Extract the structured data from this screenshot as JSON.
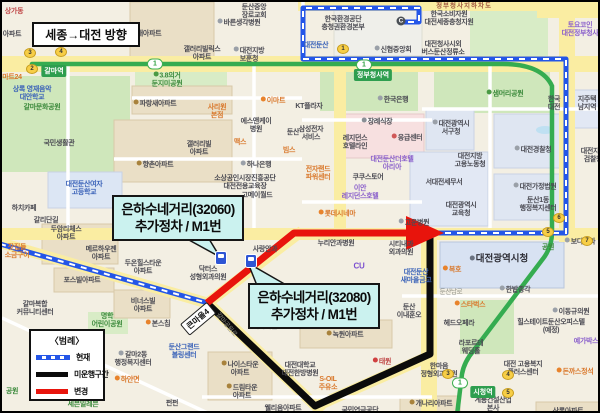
{
  "frame": {
    "direction_title": "세종→대전 방향"
  },
  "callouts": [
    {
      "line1": "은하수네거리(32060)",
      "line2": "추가정차 / M1번"
    },
    {
      "line1": "은하수네거리(32080)",
      "line2": "추가정차 / M1번"
    }
  ],
  "legend": {
    "title": "〈범례〉",
    "items": [
      {
        "label": "현재",
        "swatch": "sw-current"
      },
      {
        "label": "미운행구간",
        "swatch": "sw-removed"
      },
      {
        "label": "변경",
        "swatch": "sw-changed"
      }
    ]
  },
  "colors": {
    "route_current": "#2456E8",
    "route_removed": "#0B0B0B",
    "route_changed": "#E8140C",
    "subway_line": "#35AC50",
    "callout_bg": "#CBF2EF"
  },
  "map": {
    "road_badge": {
      "t": "큰마을4",
      "x": 196,
      "y": 317
    },
    "c_icon": {
      "x": 399,
      "y": 19
    },
    "subway_pills": [
      {
        "n": "1",
        "x": 153,
        "y": 62
      },
      {
        "n": "1",
        "x": 362,
        "y": 63
      },
      {
        "n": "1",
        "x": 458,
        "y": 381
      }
    ],
    "station_badges": [
      {
        "t": "갈마역",
        "x": 52,
        "y": 69
      },
      {
        "t": "정부청사역",
        "x": 371,
        "y": 73
      },
      {
        "t": "시청역",
        "x": 481,
        "y": 390
      }
    ],
    "exit_ovals": [
      {
        "n": "3",
        "x": 28,
        "y": 51
      },
      {
        "n": "4",
        "x": 59,
        "y": 50
      },
      {
        "n": "2",
        "x": 30,
        "y": 67
      },
      {
        "n": "1",
        "x": 341,
        "y": 47
      },
      {
        "n": "6",
        "x": 557,
        "y": 216
      },
      {
        "n": "5",
        "x": 546,
        "y": 230
      },
      {
        "n": "7",
        "x": 585,
        "y": 239
      },
      {
        "n": "3",
        "x": 446,
        "y": 372
      },
      {
        "n": "4",
        "x": 506,
        "y": 373
      },
      {
        "n": "5",
        "x": 506,
        "y": 391
      }
    ],
    "bus_stops": [
      {
        "x": 219,
        "y": 256
      },
      {
        "x": 249,
        "y": 259
      }
    ],
    "labels": [
      {
        "t": "둔산중앙\n장로교회",
        "x": 252,
        "y": 10
      },
      {
        "t": "바른생각병원",
        "x": 237,
        "y": 21,
        "ic": "#9aa0a8"
      },
      {
        "t": "상가동",
        "x": 12,
        "y": 10,
        "c": "c-red"
      },
      {
        "t": "아파트",
        "x": 10,
        "y": 33
      },
      {
        "t": "지개아파트",
        "x": 141,
        "y": 32,
        "ic": "#a8823c"
      },
      {
        "t": "갤러리빌릭스\n아파트",
        "x": 200,
        "y": 52
      },
      {
        "t": "대전지방\n보훈청",
        "x": 247,
        "y": 53,
        "ic": "#9aa0a8"
      },
      {
        "t": "한국환경공단\n충청권환경본부",
        "x": 341,
        "y": 22
      },
      {
        "t": "한국소비자원\n대전세종충청지원",
        "x": 447,
        "y": 17
      },
      {
        "t": "대전청사시외\n버스둔산정류소",
        "x": 441,
        "y": 47
      },
      {
        "t": "신협중앙회",
        "x": 391,
        "y": 48,
        "ic": "#9aa0a8"
      },
      {
        "t": "대전둔산",
        "x": 314,
        "y": 44,
        "c": "c-blue"
      },
      {
        "t": "토요코인\n대전정부청사",
        "x": 578,
        "y": 28,
        "c": "c-purple"
      },
      {
        "t": "마트24",
        "x": 10,
        "y": 76,
        "c": "c-orange"
      },
      {
        "t": "상록 영재음악\n대안학교",
        "x": 30,
        "y": 92,
        "c": "c-blue"
      },
      {
        "t": "갈마문화공원",
        "x": 40,
        "y": 106,
        "c": "c-green"
      },
      {
        "t": "3.8의거\n둔지미공원",
        "x": 165,
        "y": 78,
        "c": "c-green",
        "ic": "#4a9a44"
      },
      {
        "t": "파랑새아파트",
        "x": 153,
        "y": 102,
        "ic": "#a8823c"
      },
      {
        "t": "사리원\n본점",
        "x": 215,
        "y": 110,
        "c": "c-orange"
      },
      {
        "t": "이마트",
        "x": 271,
        "y": 99,
        "c": "c-orange",
        "ic": "#e8832c"
      },
      {
        "t": "KT플라자",
        "x": 307,
        "y": 105
      },
      {
        "t": "한국은행",
        "x": 391,
        "y": 98,
        "ic": "#9aa0a8"
      },
      {
        "t": "샘머리공원",
        "x": 503,
        "y": 92,
        "c": "c-green",
        "ic": "#4a9a44"
      },
      {
        "t": "한국\n대전",
        "x": 552,
        "y": 102
      },
      {
        "t": "지주택\n남지역",
        "x": 585,
        "y": 102
      },
      {
        "t": "에스앤케이\n병원",
        "x": 254,
        "y": 124
      },
      {
        "t": "둔산",
        "x": 291,
        "y": 131
      },
      {
        "t": "맥스",
        "x": 238,
        "y": 141,
        "c": "c-orange"
      },
      {
        "t": "빔스",
        "x": 287,
        "y": 149,
        "c": "c-orange"
      },
      {
        "t": "갤러리빌\n아파트",
        "x": 197,
        "y": 147
      },
      {
        "t": "향촌아파트",
        "x": 153,
        "y": 163,
        "ic": "#a8823c"
      },
      {
        "t": "하나은행",
        "x": 254,
        "y": 163,
        "ic": "#9aa0a8"
      },
      {
        "t": "국민생활관",
        "x": 57,
        "y": 142
      },
      {
        "t": "대전둔산여자\n고등학교",
        "x": 82,
        "y": 187,
        "c": "c-blue"
      },
      {
        "t": "소상공인시장진흥공단\n대전전용교육장",
        "x": 243,
        "y": 181
      },
      {
        "t": "고메이월드",
        "x": 255,
        "y": 194
      },
      {
        "t": "하치카페",
        "x": 22,
        "y": 207
      },
      {
        "t": "갈리단길",
        "x": 44,
        "y": 219
      },
      {
        "t": "삼성전자\n서비스",
        "x": 309,
        "y": 132
      },
      {
        "t": "장례식장",
        "x": 375,
        "y": 120,
        "ic": "#8a8f96"
      },
      {
        "t": "레지던스\n호텔라인",
        "x": 353,
        "y": 141
      },
      {
        "t": "응급센터",
        "x": 405,
        "y": 136,
        "ic": "#d05858"
      },
      {
        "t": "대전광역시\n서구청",
        "x": 449,
        "y": 126,
        "ic": "#9aa0a8"
      },
      {
        "t": "대전경찰청",
        "x": 531,
        "y": 148,
        "ic": "#9aa0a8"
      },
      {
        "t": "대전지방\n고용노동청",
        "x": 468,
        "y": 159
      },
      {
        "t": "전자랜드\n파워센터",
        "x": 316,
        "y": 172,
        "c": "c-orange"
      },
      {
        "t": "쿠쿠스토어",
        "x": 366,
        "y": 176
      },
      {
        "t": "대전둔산더호텔\n아리아",
        "x": 390,
        "y": 162,
        "c": "c-purple"
      },
      {
        "t": "서대전세무서",
        "x": 442,
        "y": 181
      },
      {
        "t": "대전가정법원",
        "x": 533,
        "y": 185,
        "ic": "#9aa0a8"
      },
      {
        "t": "대전지방\n검찰청",
        "x": 591,
        "y": 154
      },
      {
        "t": "이안\n레지던스호텔",
        "x": 358,
        "y": 191,
        "c": "c-purple"
      },
      {
        "t": "대전광역시\n교육청",
        "x": 459,
        "y": 208
      },
      {
        "t": "둔산1동\n행정복지센터",
        "x": 536,
        "y": 203
      },
      {
        "t": "롯데시네마",
        "x": 335,
        "y": 212,
        "c": "c-orange",
        "ic": "#e8832c"
      },
      {
        "t": "고운병원",
        "x": 412,
        "y": 221,
        "ic": "#9aa0a8"
      },
      {
        "t": "두암리체스\n아파트",
        "x": 64,
        "y": 232
      },
      {
        "t": "메르하우젠\n아파트",
        "x": 99,
        "y": 252
      },
      {
        "t": "잣집들\n소금구이",
        "x": 15,
        "y": 250,
        "c": "c-orange"
      },
      {
        "t": "누리안과병원",
        "x": 334,
        "y": 242
      },
      {
        "t": "시티내과\n외과의원",
        "x": 399,
        "y": 247
      },
      {
        "t": "사랑안과",
        "x": 263,
        "y": 248
      },
      {
        "t": "닥터스\n성형외과의원",
        "x": 206,
        "y": 272
      },
      {
        "t": "두온힐스타운\n아파트",
        "x": 141,
        "y": 266
      },
      {
        "t": "포스빌아파트",
        "x": 80,
        "y": 279
      },
      {
        "t": "CU",
        "x": 357,
        "y": 264,
        "c": "c-purple-bold"
      },
      {
        "t": "대전둔산\n새마을금고",
        "x": 414,
        "y": 275,
        "c": "c-blue"
      },
      {
        "t": "복호",
        "x": 450,
        "y": 268,
        "c": "c-orange",
        "ic": "#e8832c"
      },
      {
        "t": "보다안과",
        "x": 578,
        "y": 240,
        "ic": "#9aa0a8"
      },
      {
        "t": "공원",
        "x": 546,
        "y": 246,
        "c": "c-green"
      },
      {
        "t": "대전광역시청",
        "x": 497,
        "y": 258,
        "c": "c-big",
        "ic": "#6a7280"
      },
      {
        "t": "한밭종각",
        "x": 513,
        "y": 288,
        "ic": "#9aa0a8"
      },
      {
        "t": "둔산\n이내훈오",
        "x": 407,
        "y": 310
      },
      {
        "t": "갈마복합\n커뮤니티센터",
        "x": 33,
        "y": 307
      },
      {
        "t": "비너스빌\n아파트",
        "x": 141,
        "y": 304
      },
      {
        "t": "명학\n어린이공원",
        "x": 105,
        "y": 319,
        "c": "c-green"
      },
      {
        "t": "본스칩",
        "x": 156,
        "y": 322,
        "ic": "#e8832c"
      },
      {
        "t": "둔산그랜드\n볼링센터",
        "x": 182,
        "y": 350,
        "c": "c-blue"
      },
      {
        "t": "갈마2동\n행정복지센터",
        "x": 131,
        "y": 357,
        "ic": "#9aa0a8"
      },
      {
        "t": "하얀면",
        "x": 125,
        "y": 378,
        "c": "c-orange",
        "ic": "#e8832c"
      },
      {
        "t": "세븐일레븐",
        "x": 81,
        "y": 403,
        "c": "c-green"
      },
      {
        "t": "펀펀",
        "x": 170,
        "y": 402
      },
      {
        "t": "공원",
        "x": 10,
        "y": 390,
        "c": "c-green"
      },
      {
        "t": "치과의원",
        "x": 263,
        "y": 325
      },
      {
        "t": "녹원아파트",
        "x": 343,
        "y": 333,
        "ic": "#a8823c"
      },
      {
        "t": "나이스타운\n아파트",
        "x": 238,
        "y": 367,
        "ic": "#a8823c"
      },
      {
        "t": "드림타운\n아파트",
        "x": 240,
        "y": 390,
        "ic": "#a8823c"
      },
      {
        "t": "대전대학교\n대전한방병원",
        "x": 298,
        "y": 368
      },
      {
        "t": "웰리움아파트",
        "x": 281,
        "y": 407
      },
      {
        "t": "S-OIL\n주유소",
        "x": 326,
        "y": 382,
        "c": "c-orange"
      },
      {
        "t": "국민연금공단",
        "x": 358,
        "y": 409
      },
      {
        "t": "태원",
        "x": 380,
        "y": 360,
        "c": "c-red",
        "ic": "#d04040"
      },
      {
        "t": "한마음\n정형외과의원",
        "x": 437,
        "y": 369
      },
      {
        "t": "개나리아파트",
        "x": 429,
        "y": 402,
        "ic": "#a8823c"
      },
      {
        "t": "계룡건설산업\n본사",
        "x": 491,
        "y": 403
      },
      {
        "t": "스타벅스",
        "x": 468,
        "y": 303,
        "c": "c-orange",
        "ic": "#e8832c"
      },
      {
        "t": "헤드오페라",
        "x": 457,
        "y": 322
      },
      {
        "t": "이동규의원",
        "x": 569,
        "y": 310,
        "ic": "#9aa0a8"
      },
      {
        "t": "힐스테이트둔산오피스텔\n(예정)",
        "x": 549,
        "y": 325
      },
      {
        "t": "라포르테\n웨딩홀",
        "x": 469,
        "y": 346
      },
      {
        "t": "대전 고용복지\n플러스센터",
        "x": 521,
        "y": 367
      },
      {
        "t": "돈까스정석",
        "x": 573,
        "y": 370,
        "c": "c-orange",
        "ic": "#e8832c"
      },
      {
        "t": "예가박스",
        "x": 584,
        "y": 340,
        "c": "c-purple"
      },
      {
        "t": "상록아파트",
        "x": 566,
        "y": 410
      },
      {
        "t": "정부청사지하차도",
        "x": 462,
        "y": 4,
        "c": "c-brownroad"
      },
      {
        "t": "둔산남로",
        "x": 449,
        "y": 290,
        "c": "c-road"
      },
      {
        "t": "갈마공원로",
        "x": 224,
        "y": 323,
        "c": "c-road",
        "rot": 50
      }
    ]
  }
}
